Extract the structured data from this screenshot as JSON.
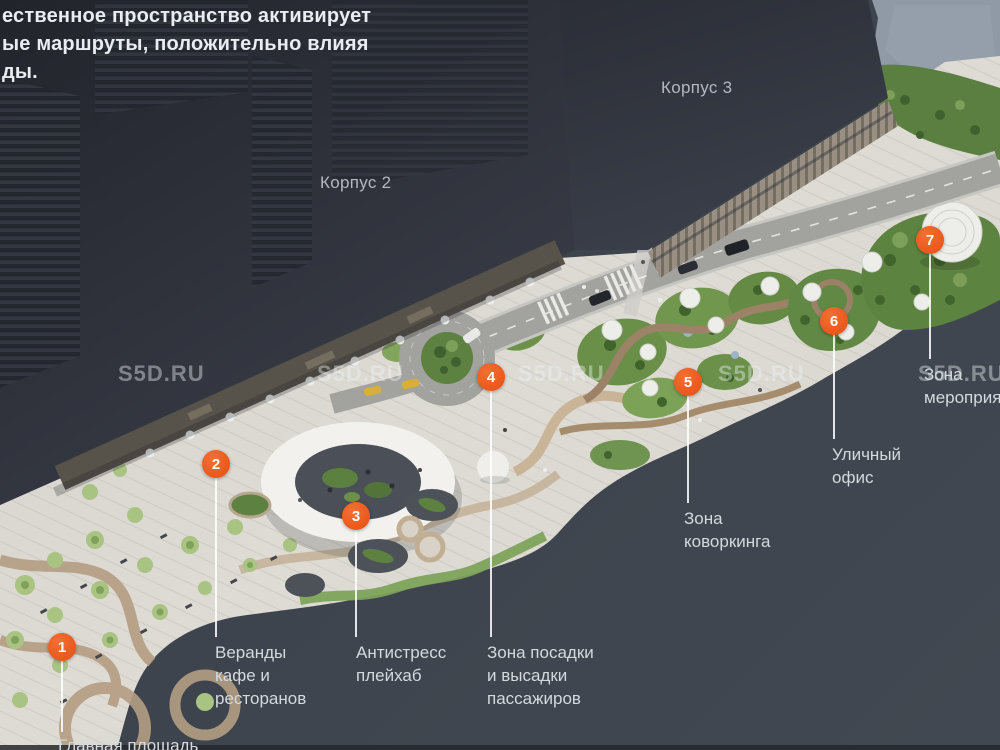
{
  "slide": {
    "intro_lines": [
      "ественное пространство активирует",
      "ые маршруты, положительно влияя",
      "ды."
    ],
    "watermark_text": "S5D.RU"
  },
  "buildings": {
    "korpus2": "Корпус 2",
    "korpus3": "Корпус 3"
  },
  "markers": [
    {
      "number": "1",
      "label": "Главная площадь"
    },
    {
      "number": "2",
      "label": "Веранды кафе и ресторанов"
    },
    {
      "number": "3",
      "label": "Антистресс плейхаб"
    },
    {
      "number": "4",
      "label": "Зона посадки и высадки пассажиров"
    },
    {
      "number": "5",
      "label": "Зона коворкинга"
    },
    {
      "number": "6",
      "label": "Уличный офис"
    },
    {
      "number": "7",
      "label": "Зона мероприятий"
    }
  ],
  "colors": {
    "marker_accent": "#e95321",
    "background": "#3e444d",
    "label_text": "#d4d9de",
    "plaza": "#dbd8d1",
    "watermark": "#aab0b8"
  }
}
